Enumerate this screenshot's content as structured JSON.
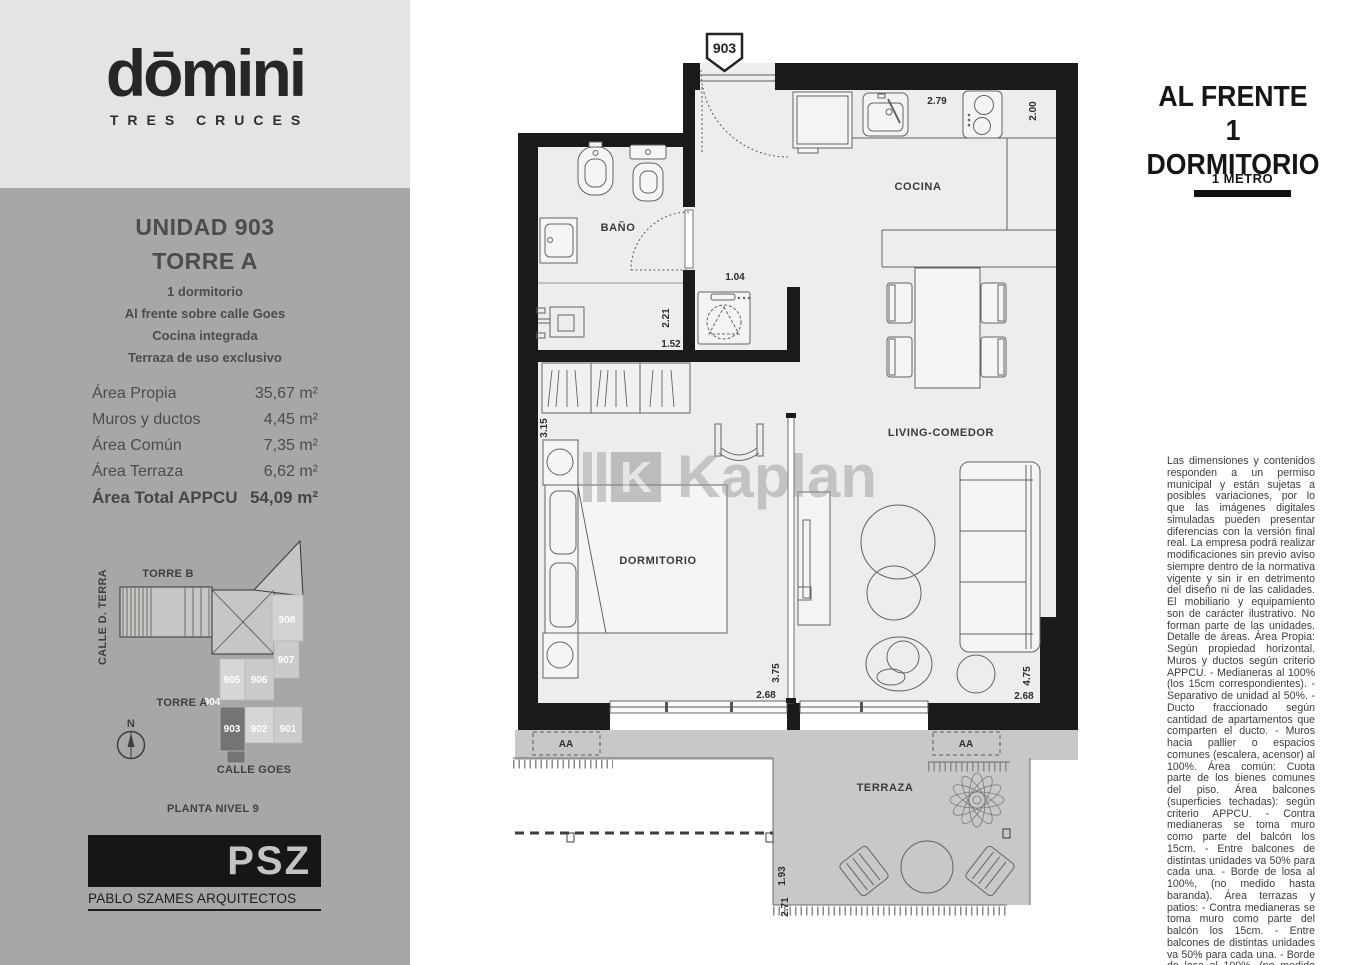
{
  "brand": {
    "logo_text": "dōmini",
    "logo_sub": "TRES CRUCES"
  },
  "unit_card": {
    "title": "UNIDAD 903",
    "tower": "TORRE A",
    "features": [
      "1 dormitorio",
      "Al frente sobre calle Goes",
      "Cocina integrada",
      "Terraza de uso exclusivo"
    ],
    "areas": [
      {
        "label": "Área Propia",
        "value": "35,67 m²"
      },
      {
        "label": "Muros y ductos",
        "value": "4,45 m²"
      },
      {
        "label": "Área Común",
        "value": "7,35 m²"
      },
      {
        "label": "Área Terraza",
        "value": "6,62 m²"
      },
      {
        "label": "Área Total APPCU",
        "value": "54,09 m²"
      }
    ]
  },
  "key_plan": {
    "torre_b": "TORRE B",
    "torre_a": "TORRE A",
    "street_left": "CALLE D. TERRA",
    "street_bottom": "CALLE GOES",
    "north": "N",
    "caption": "PLANTA NIVEL 9",
    "units": {
      "u908": "908",
      "u907": "907",
      "u905": "905",
      "u906": "906",
      "u904": "904",
      "u903": "903",
      "u902": "902",
      "u901": "901"
    }
  },
  "architect": {
    "initials": "PSZ",
    "name": "PABLO SZAMES ARQUITECTOS"
  },
  "header": {
    "line1": "AL FRENTE",
    "line2": "1 DORMITORIO",
    "scale_label": "1 METRO"
  },
  "plan": {
    "unit_marker": "903",
    "aa_label": "AA",
    "rooms": {
      "cocina": "COCINA",
      "bano": "BAÑO",
      "dormitorio": "DORMITORIO",
      "living": "LIVING-COMEDOR",
      "terraza": "TERRAZA"
    },
    "dims": {
      "cocina_w": "2.79",
      "cocina_d": "2.00",
      "hall_w": "1.04",
      "lavadero_h": "2.21",
      "lavadero_w": "1.52",
      "dormitorio_h": "3.15",
      "dorm_win_h": "3.75",
      "dorm_win_w": "2.68",
      "living_win_h": "4.75",
      "living_win_w": "2.68",
      "terraza_h": "1.93",
      "terraza_w": "2.71"
    }
  },
  "watermark": {
    "text": "Kaplan",
    "mark": "K"
  },
  "disclaimer": {
    "text": "Las dimensiones y contenidos responden a un permiso municipal y están sujetas a posibles variaciones, por lo que las imágenes digitales simuladas pueden presentar diferencias con la versión final real. La empresa podrá realizar modificaciones sin previo aviso siempre dentro de la normativa vigente y sin ir en detrimento del diseño ni de las calidades. El mobiliario y equipamiento son de carácter ilustrativo. No forman parte de las unidades. Detalle de áreas. Área Propia: Según propiedad horizontal. Muros y ductos según criterio APPCU. - Medianeras al 100% (los 15cm correspondientes). - Separativo de unidad al 50%. - Ducto fraccionado según cantidad de apartamentos que comparten el ducto. - Muros hacia pallier o espacios comunes (escalera, acensor) al 100%. Área común: Cuota parte de los bienes comunes del piso. Área balcones (superficies techadas): según criterio APPCU. - Contra medianeras se toma muro como parte del balcón los 15cm. - Entre balcones de distintas unidades va  50% para cada una. - Borde de losa al 100%, (no medido hasta baranda). Área terrazas y patios: - Contra medianeras se toma muro como parte del balcón los 15cm. - Entre balcones de distintas unidades va  50% para cada una. - Borde de losa al 100%, (no medido hasta baranda)."
  }
}
